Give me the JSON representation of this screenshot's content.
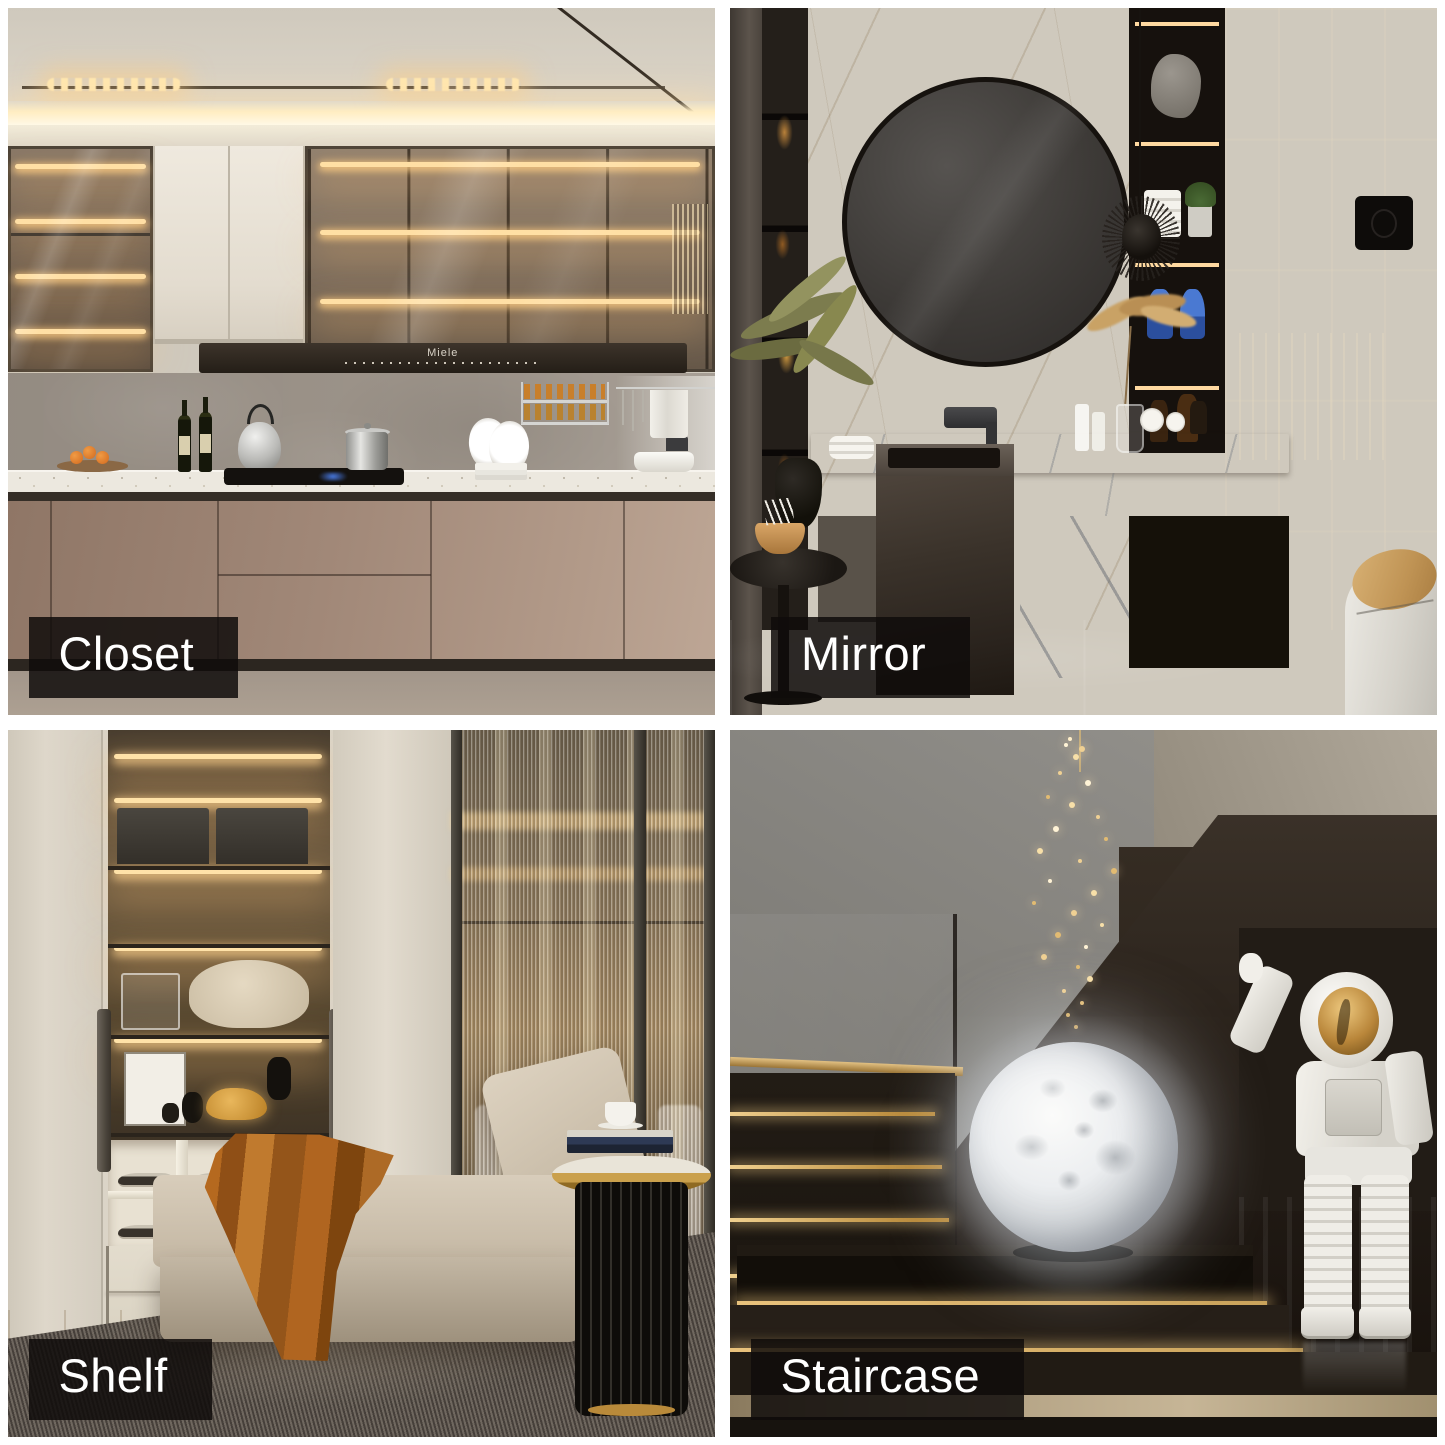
{
  "collage": {
    "background": "#ffffff",
    "caption_bg": "rgba(15,12,10,0.85)",
    "caption_color": "#ffffff"
  },
  "tiles": {
    "closet": {
      "label": "Closet"
    },
    "mirror": {
      "label": "Mirror"
    },
    "shelf": {
      "label": "Shelf"
    },
    "staircase": {
      "label": "Staircase"
    }
  },
  "kitchen": {
    "hood_brand": "Miele"
  },
  "palette": {
    "warm_led": "#ffdca6",
    "gold": "#c9973a",
    "cabinet_taupe": "#a18878",
    "marble_white": "#e9e3d8",
    "dark_stone": "#3a322c",
    "moon_grey": "#dfe3e7"
  }
}
